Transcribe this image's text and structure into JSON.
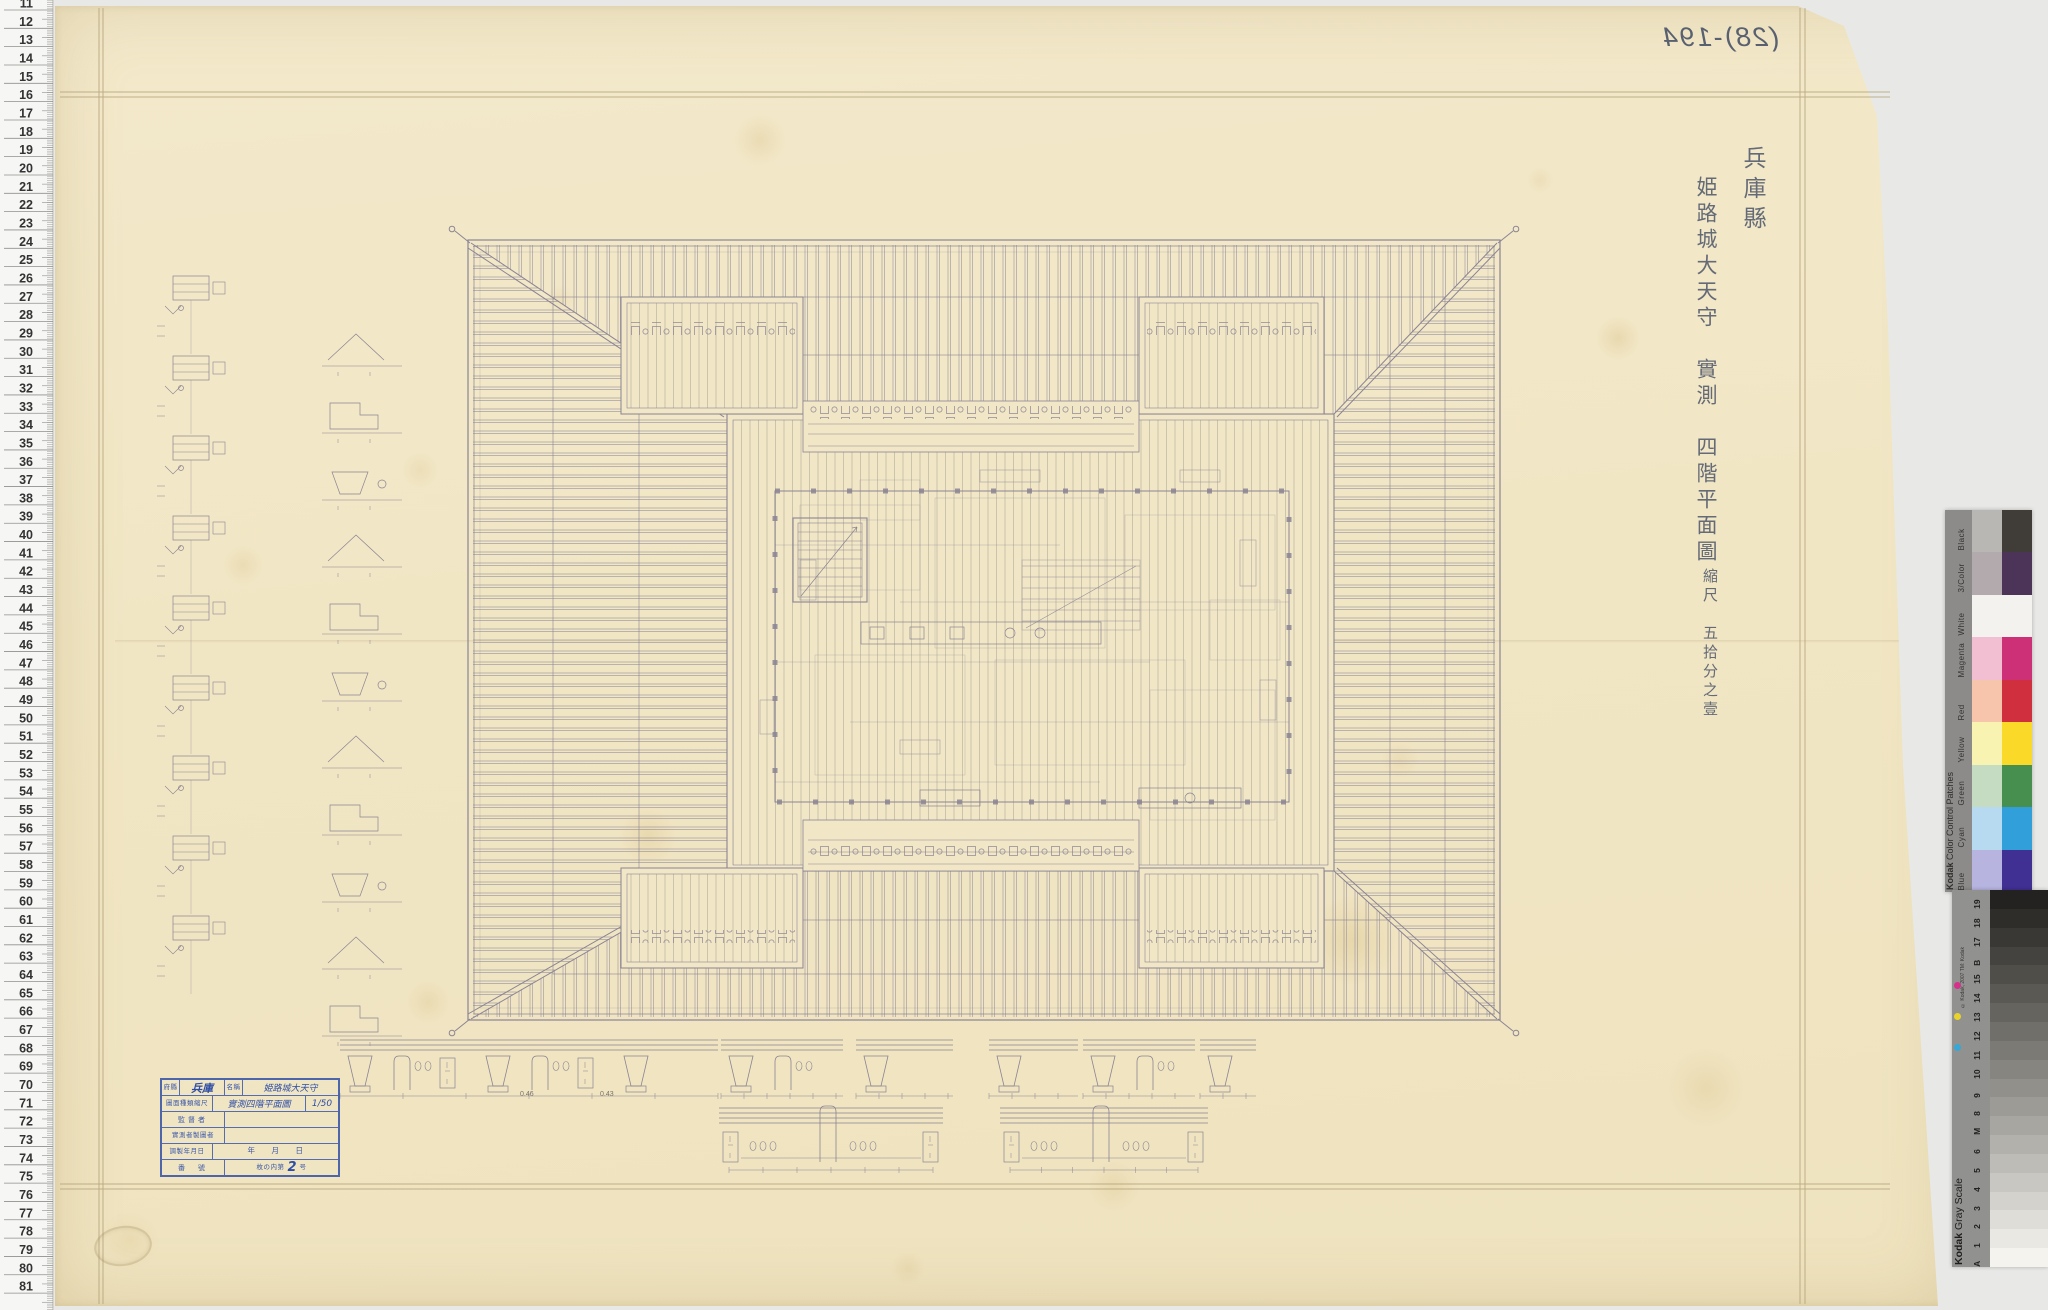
{
  "document": {
    "mirror_number": "(28)-194",
    "inscription": {
      "prefecture": "兵庫縣",
      "title": "姫路城大天守　實測　四階平面圖",
      "scale_text": "縮尺　五拾分之壹"
    },
    "title_block": {
      "pref_label": "府縣",
      "pref": "兵庫",
      "name_label": "名稱",
      "name": "姫路城大天守",
      "type_label": "圖面種類縮尺",
      "type": "實測四階平面圖",
      "scale": "1/50",
      "supervisor_label": "監督者",
      "surveyor_label": "實測者製圖者",
      "date_label": "調製年月日",
      "date_value": "年　　月　　日",
      "number_label": "番　號",
      "number_prefix": "枚の内第",
      "number": "2",
      "number_suffix": "号"
    },
    "dim_annotations": [
      "0.46",
      "0.43"
    ]
  },
  "ruler": {
    "unit_numbers": [
      11,
      12,
      13,
      14,
      15,
      16,
      17,
      18,
      19,
      20,
      21,
      22,
      23,
      24,
      25,
      26,
      27,
      28,
      29,
      30,
      31,
      32,
      33,
      34,
      35,
      36,
      37,
      38,
      39,
      40,
      41,
      42,
      43,
      44,
      45,
      46,
      47,
      48,
      49,
      50,
      51,
      52,
      53,
      54,
      55,
      56,
      57,
      58,
      59,
      60,
      61,
      62,
      63,
      64,
      65,
      66,
      67,
      68,
      69,
      70,
      71,
      72,
      73,
      74,
      75,
      76,
      77,
      78,
      79,
      80,
      81
    ]
  },
  "kodak_color_patches": {
    "title_brand": "Kodak",
    "title_rest": " Color Control Patches",
    "rows": [
      {
        "name": "Black",
        "tint": "#b9b7b4",
        "solid": "#403c37"
      },
      {
        "name": "3/Color",
        "tint": "#b3aaae",
        "solid": "#4b3457"
      },
      {
        "name": "White",
        "tint": "#f3f2ef",
        "solid": "#f3f2ef"
      },
      {
        "name": "Magenta",
        "tint": "#f2bed2",
        "solid": "#ce3078"
      },
      {
        "name": "Red",
        "tint": "#f6c5ab",
        "solid": "#d02f3d"
      },
      {
        "name": "Yellow",
        "tint": "#f8f3b0",
        "solid": "#fbd929"
      },
      {
        "name": "Green",
        "tint": "#c5dcc2",
        "solid": "#478f4e"
      },
      {
        "name": "Cyan",
        "tint": "#b7daf1",
        "solid": "#31a0da"
      },
      {
        "name": "Blue",
        "tint": "#b7b4e0",
        "solid": "#413093"
      }
    ]
  },
  "kodak_gray_scale": {
    "title_brand": "Kodak",
    "title_rest": " Gray Scale",
    "copyright": "© Kodak, 2007 TM: Kodak",
    "cmy_dot_colors": [
      "#d6308c",
      "#e8d32a",
      "#35a8d8"
    ],
    "steps": [
      {
        "label": "19",
        "color": "#242220"
      },
      {
        "label": "18",
        "color": "#2f2d2a"
      },
      {
        "label": "17",
        "color": "#3a3834"
      },
      {
        "label": "B",
        "color": "#45433f"
      },
      {
        "label": "15",
        "color": "#504e49"
      },
      {
        "label": "14",
        "color": "#5b5954"
      },
      {
        "label": "13",
        "color": "#66645f"
      },
      {
        "label": "12",
        "color": "#716f69"
      },
      {
        "label": "11",
        "color": "#7c7a74"
      },
      {
        "label": "10",
        "color": "#87857f"
      },
      {
        "label": "9",
        "color": "#92908a"
      },
      {
        "label": "8",
        "color": "#9d9b95"
      },
      {
        "label": "M",
        "color": "#a8a6a0"
      },
      {
        "label": "6",
        "color": "#b3b1ab"
      },
      {
        "label": "5",
        "color": "#bebcb6"
      },
      {
        "label": "4",
        "color": "#c9c7c1"
      },
      {
        "label": "3",
        "color": "#d4d2cc"
      },
      {
        "label": "2",
        "color": "#dfddd7"
      },
      {
        "label": "1",
        "color": "#eae8e2"
      },
      {
        "label": "A",
        "color": "#f5f3ed"
      }
    ]
  },
  "colors": {
    "paper": "#f1e6c4",
    "pencil_line": "#8b8493",
    "stamp_blue": "#3b57a8",
    "ink_blue": "#2e4da6",
    "background": "#e8e8e6"
  }
}
